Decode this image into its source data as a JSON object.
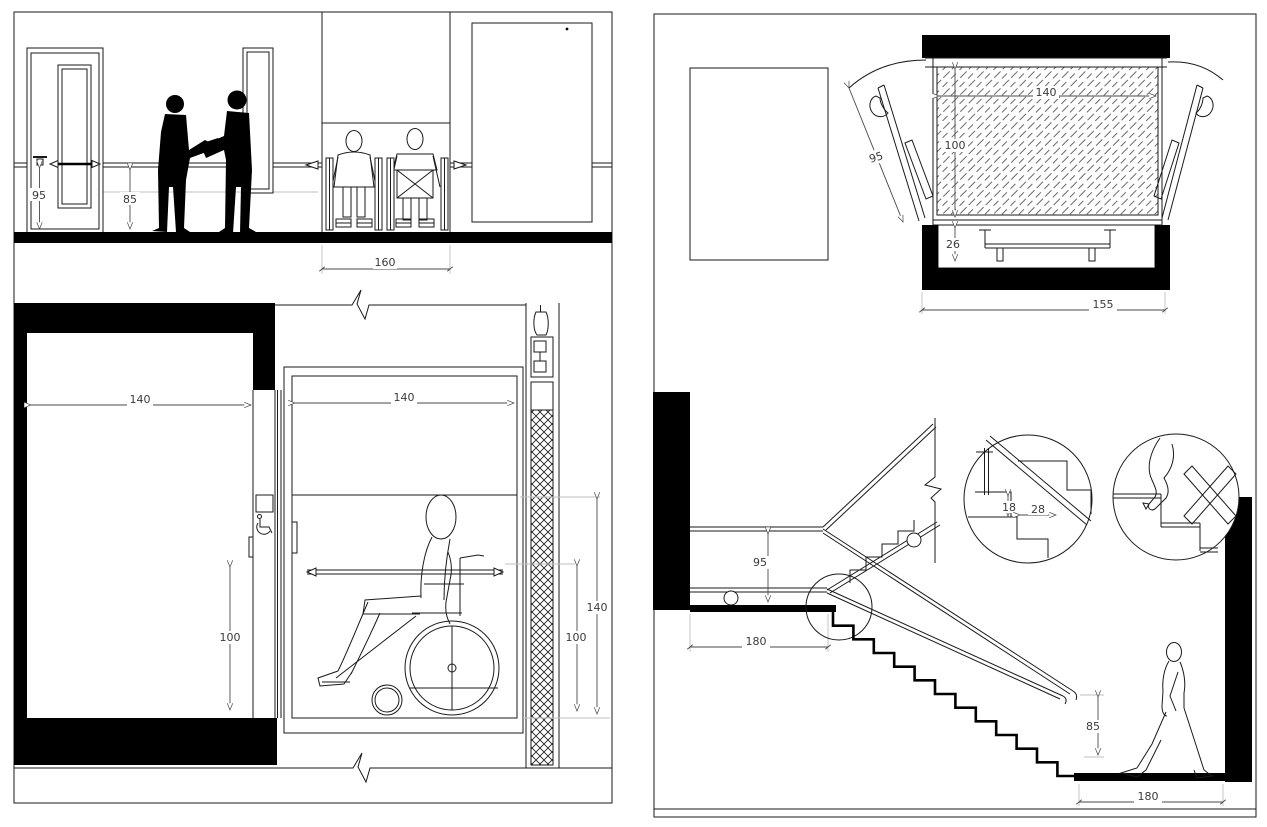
{
  "drawing": {
    "type": "accessibility-design-standards-sheet",
    "panels": [
      "corridor-and-lift-elevation",
      "lift-plan-and-stair-section"
    ]
  },
  "dims": {
    "corridor": {
      "handle_height": "95",
      "handrail_height": "85",
      "clear_width": "160"
    },
    "lift_section": {
      "shaft_width": "140",
      "cabin_width": "140",
      "handrail_height_left": "100",
      "handrail_height_right": "100",
      "door_panel_height": "140"
    },
    "lift_plan": {
      "cabin_width": "140",
      "cabin_depth": "100",
      "door_leaf": "95",
      "sill_clearance": "26",
      "overall_width": "155"
    },
    "stairs": {
      "handrail_height": "95",
      "upper_landing": "180",
      "riser_detail": "18",
      "tread_detail": "28",
      "flight_handrail_height": "85",
      "lower_landing": "180"
    }
  }
}
